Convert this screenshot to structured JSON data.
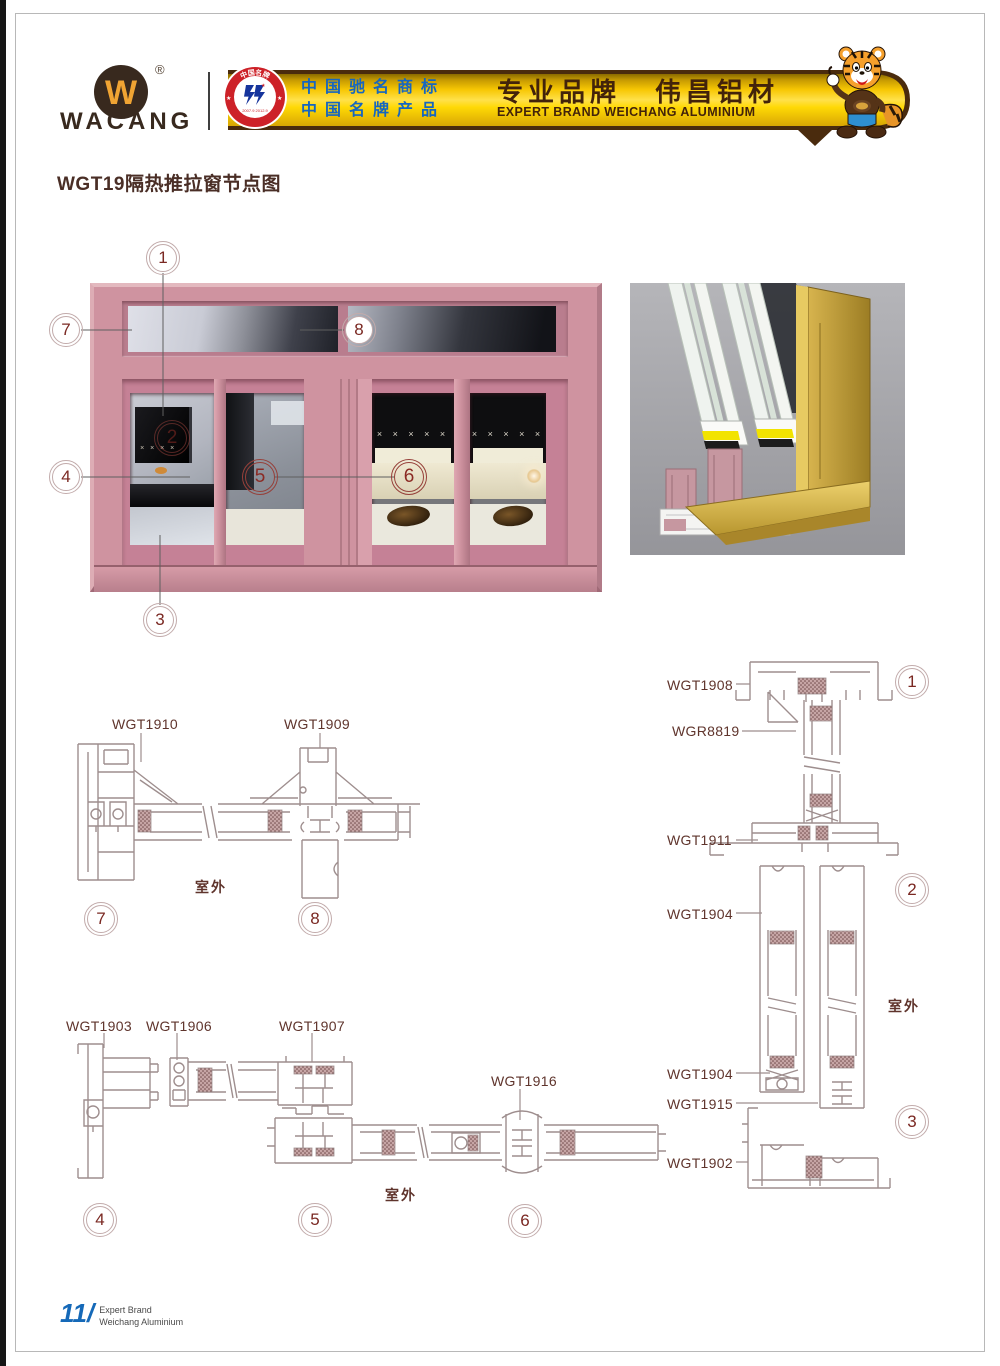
{
  "header": {
    "brand": "WACANG",
    "registered": "®",
    "badge": {
      "top": "中国名牌",
      "bottom": "CHINA TOP BRAND",
      "dates": "2007.9  2012.9"
    },
    "banner": {
      "cn_line1": "中国驰名商标",
      "cn_line2": "中国名牌产品",
      "zh_left": "专业品牌",
      "zh_right": "伟昌铝材",
      "en": "EXPERT BRAND WEICHANG ALUMINIUM"
    }
  },
  "title": "WGT19隔热推拉窗节点图",
  "outdoor_label": "室外",
  "callouts": {
    "n1": "1",
    "n2": "2",
    "n3": "3",
    "n4": "4",
    "n5": "5",
    "n6": "6",
    "n7": "7",
    "n8": "8"
  },
  "part_labels": {
    "wgt1910": "WGT1910",
    "wgt1909": "WGT1909",
    "wgt1908": "WGT1908",
    "wgr8819": "WGR8819",
    "wgt1911": "WGT1911",
    "wgt1904": "WGT1904",
    "wgt1915": "WGT1915",
    "wgt1902": "WGT1902",
    "wgt1903": "WGT1903",
    "wgt1906": "WGT1906",
    "wgt1907": "WGT1907",
    "wgt1916": "WGT1916"
  },
  "elevation": {
    "x_row": "× × × × ×",
    "tv_marks": "× × × ×"
  },
  "footer": {
    "page_number": "11",
    "divider": "/",
    "line1": "Expert Brand",
    "line2": "Weichang Aluminium"
  },
  "colors": {
    "frame_pink": "#cf93a0",
    "drawing_line": "#9e8e8e",
    "label_text": "#5f342c",
    "banner_yellow": "#ffd40a",
    "banner_blue": "#1666c0",
    "banner_brown": "#43230a",
    "logo_brown": "#38291e",
    "footer_blue": "#1569b8",
    "callout_red": "#8b2a24",
    "gold_profile": "#c9a63e"
  }
}
